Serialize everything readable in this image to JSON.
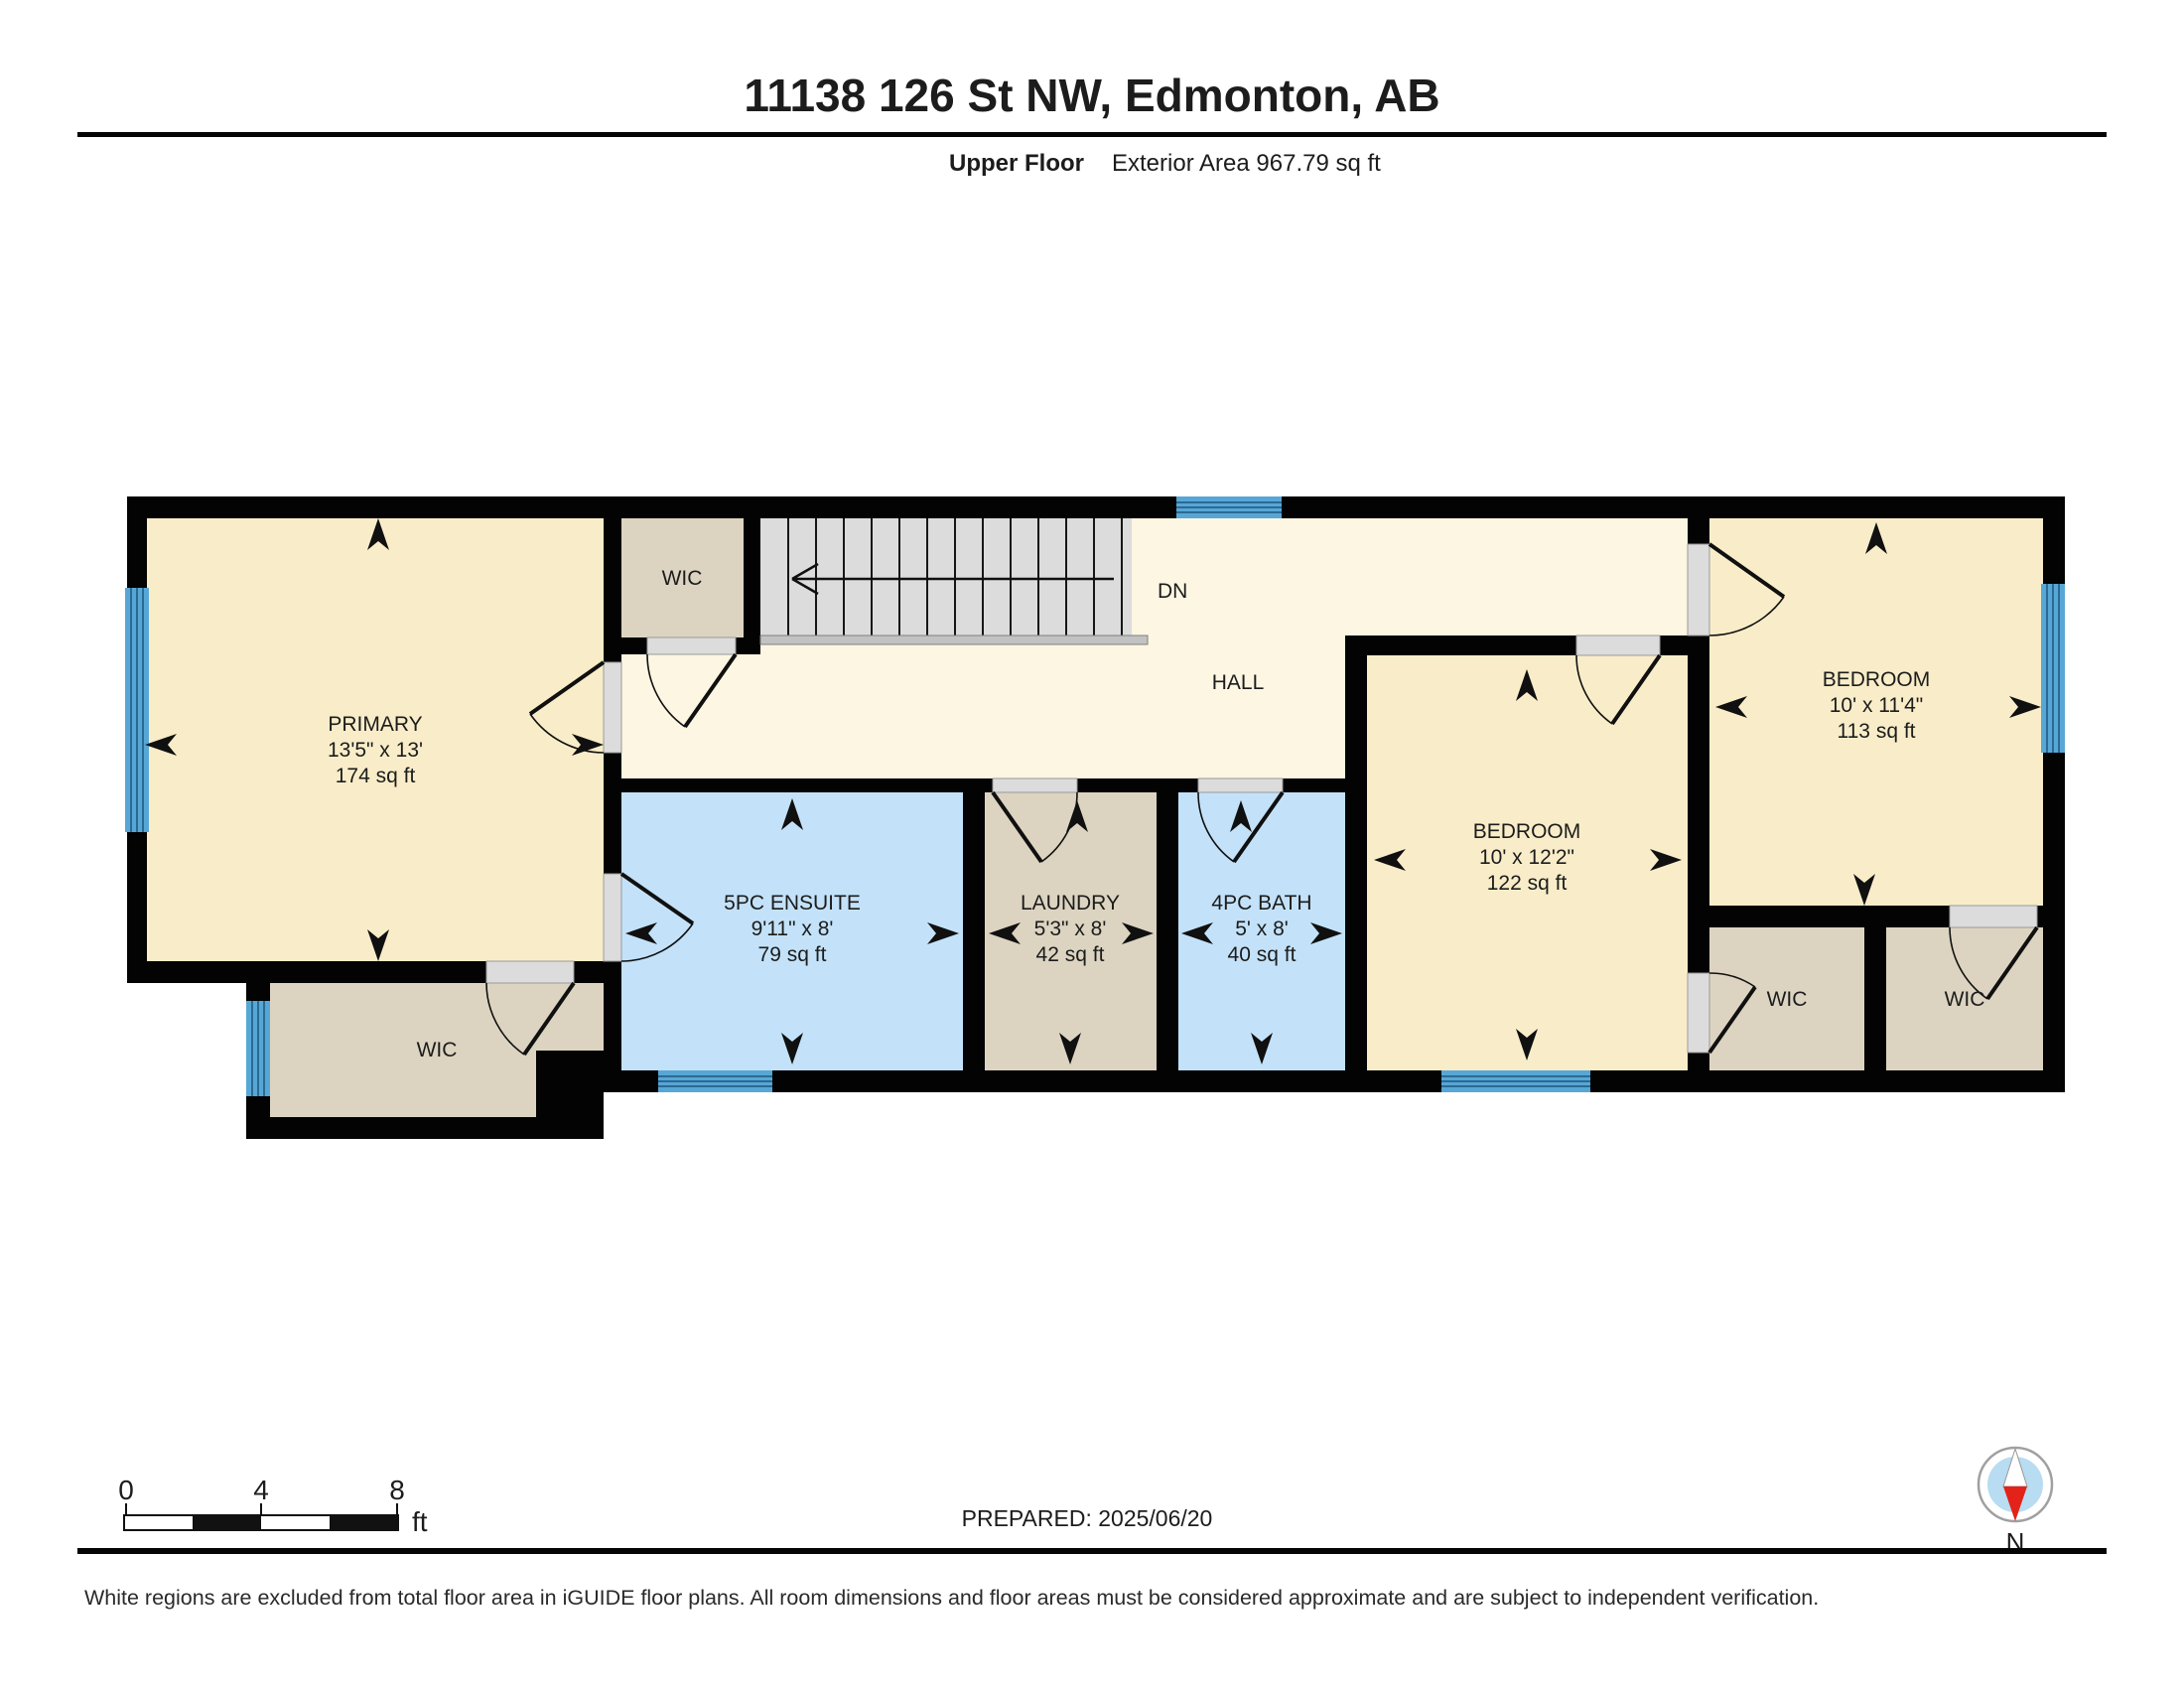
{
  "header": {
    "title": "11138 126 St NW, Edmonton, AB",
    "floor_label": "Upper Floor",
    "area_label": "Exterior Area 967.79 sq ft"
  },
  "rooms": {
    "primary": {
      "name": "PRIMARY",
      "dims": "13'5\" x 13'",
      "area": "174 sq ft"
    },
    "ensuite": {
      "name": "5PC ENSUITE",
      "dims": "9'11\" x 8'",
      "area": "79 sq ft"
    },
    "laundry": {
      "name": "LAUNDRY",
      "dims": "5'3\" x 8'",
      "area": "42 sq ft"
    },
    "bath": {
      "name": "4PC BATH",
      "dims": "5' x 8'",
      "area": "40 sq ft"
    },
    "bedroom_mid": {
      "name": "BEDROOM",
      "dims": "10' x 12'2\"",
      "area": "122 sq ft"
    },
    "bedroom_right": {
      "name": "BEDROOM",
      "dims": "10' x 11'4\"",
      "area": "113 sq ft"
    },
    "hall": {
      "name": "HALL"
    },
    "stairs": {
      "label": "DN"
    },
    "wic_top": {
      "name": "WIC"
    },
    "wic_left": {
      "name": "WIC"
    },
    "wic_right_a": {
      "name": "WIC"
    },
    "wic_right_b": {
      "name": "WIC"
    }
  },
  "scale_bar": {
    "tick0": "0",
    "tick4": "4",
    "tick8": "8",
    "unit": "ft"
  },
  "footer": {
    "prepared": "PREPARED: 2025/06/20",
    "compass_label": "N",
    "disclaimer": "White regions are excluded from total floor area in iGUIDE floor plans. All room dimensions and floor areas must be considered approximate and are subject to independent verification."
  },
  "theme": {
    "room-cream": "#F9EDC9",
    "hall-cream": "#FCF6E2",
    "room-blue": "#C3E2F9",
    "closet-tan": "#DCD4C1",
    "stairs-gray": "#DCDCDC",
    "window-blue": "#57A7D6",
    "window-line": "#2B6A92",
    "wall-black": "#030303",
    "door-sill": "#DCDCDC"
  }
}
